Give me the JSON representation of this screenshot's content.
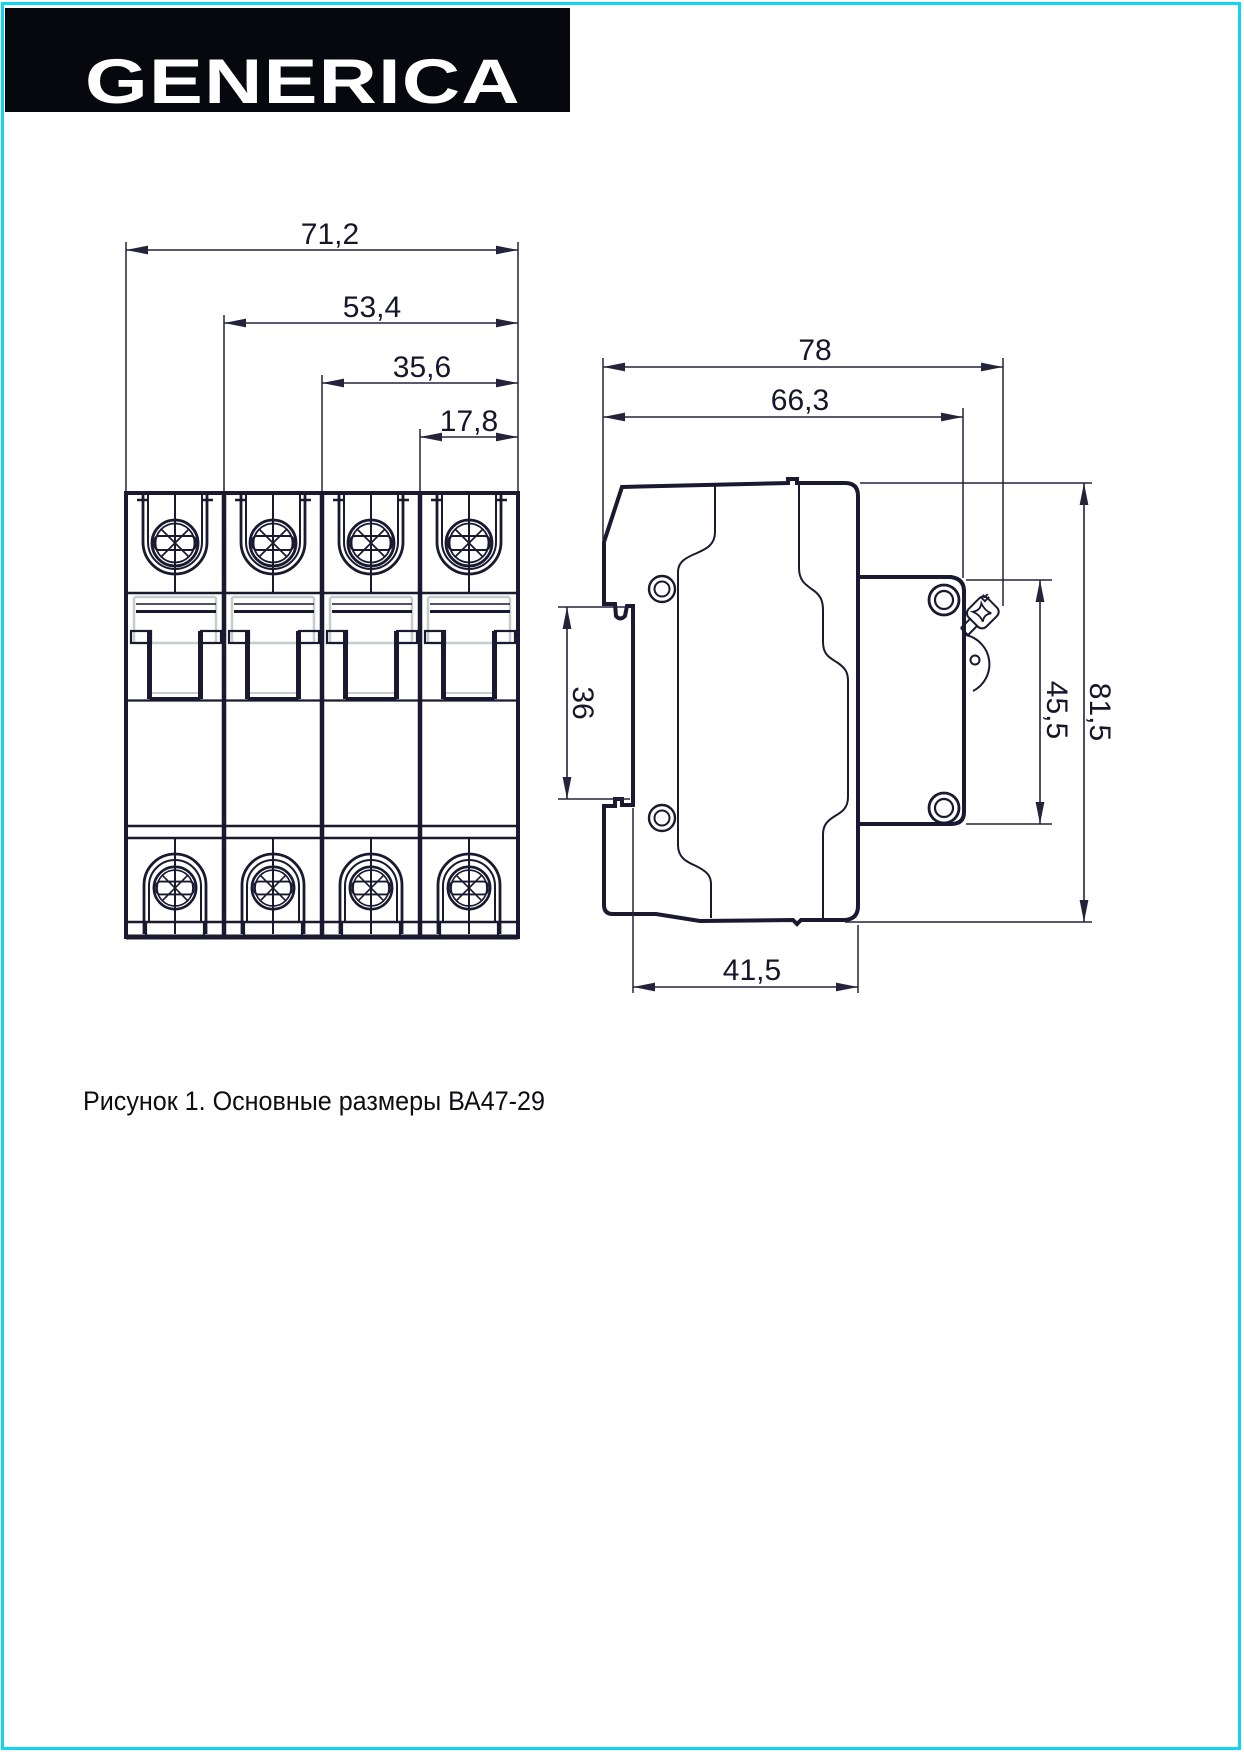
{
  "page": {
    "background": "#ffffff",
    "border_color": "#0fd4f4",
    "line_color": "#191930",
    "light_line_color": "#c5cecd"
  },
  "logo": {
    "text": "GENERICA",
    "background": "#06080e",
    "foreground": "#ffffff"
  },
  "figure": {
    "caption": "Рисунок 1. Основные размеры ВА47-29",
    "product": "ВА47-29",
    "views": {
      "front": {
        "title": "front view, 4-pole breaker",
        "dimensions": [
          {
            "name": "overall-width",
            "label": "71,2"
          },
          {
            "name": "three-pole-width",
            "label": "53,4"
          },
          {
            "name": "two-pole-width",
            "label": "35,6"
          },
          {
            "name": "one-pole-width",
            "label": "17,8"
          }
        ]
      },
      "side": {
        "title": "side view",
        "dimensions": [
          {
            "name": "overall-depth",
            "label": "78"
          },
          {
            "name": "depth-to-front-face",
            "label": "66,3"
          },
          {
            "name": "din-rail-recess",
            "label": "36"
          },
          {
            "name": "front-part-height",
            "label": "45,5"
          },
          {
            "name": "overall-height",
            "label": "81,5"
          },
          {
            "name": "base-depth",
            "label": "41,5"
          }
        ]
      }
    }
  }
}
